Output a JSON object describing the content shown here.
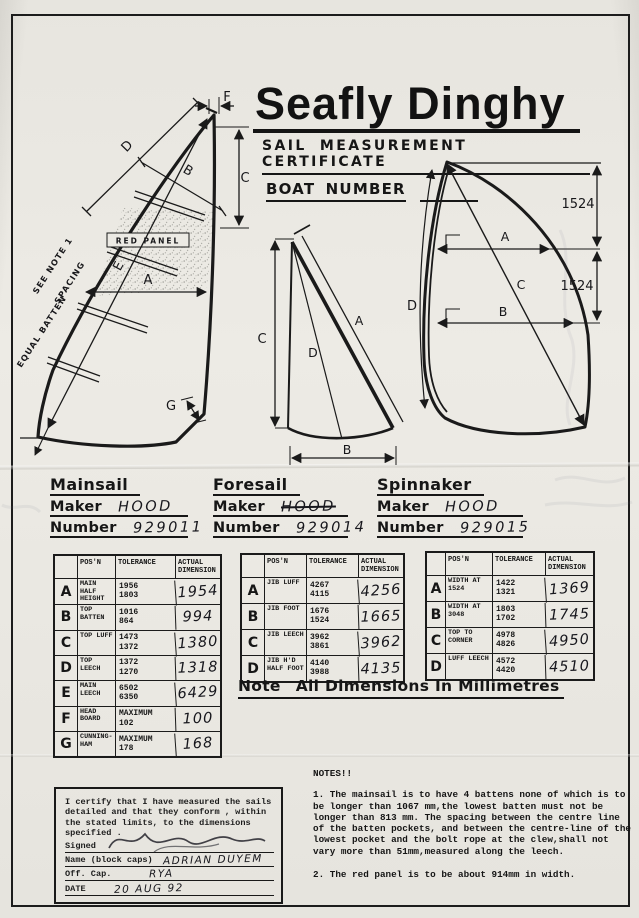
{
  "header": {
    "title": "Seafly Dinghy",
    "subtitle": "SAIL MEASUREMENT CERTIFICATE",
    "boat_number_label": "BOAT NUMBER"
  },
  "diagrams": {
    "mainsail": {
      "dim_f": "F",
      "dim_d": "D",
      "dim_b": "B",
      "dim_c": "C",
      "dim_e": "E",
      "dim_a": "A",
      "dim_g": "G",
      "red_panel_label": "RED PANEL",
      "see_note_label": "SEE NOTE 1",
      "spacing_label": "SPACING",
      "equal_batten_label": "EQUAL BATTEN"
    },
    "foresail": {
      "dim_c": "C",
      "dim_a": "A",
      "dim_d": "D",
      "dim_b": "B"
    },
    "spinnaker": {
      "dim_a": "A",
      "dim_b": "B",
      "dim_c": "C",
      "dim_d": "D",
      "upper_span_mm": "1524",
      "lower_span_mm": "1524"
    }
  },
  "sail_ids": {
    "maker_label": "Maker",
    "number_label": "Number",
    "mainsail": {
      "section_label": "Mainsail",
      "maker": "HOOD",
      "number": "929011"
    },
    "foresail": {
      "section_label": "Foresail",
      "maker": "HOOD",
      "number": "929014"
    },
    "spinnaker": {
      "section_label": "Spinnaker",
      "maker": "HOOD",
      "number": "929015"
    }
  },
  "tables": {
    "col_posn": "POS'N",
    "col_tolerance": "TOLERANCE",
    "col_actual": "ACTUAL DIMENSION",
    "mainsail": {
      "rows": [
        {
          "key": "A",
          "posn": "MAIN HALF HEIGHT",
          "tol_max": "1956",
          "tol_min": "1803",
          "actual": "1954"
        },
        {
          "key": "B",
          "posn": "TOP BATTEN",
          "tol_max": "1016",
          "tol_min": "864",
          "actual": "994"
        },
        {
          "key": "C",
          "posn": "TOP LUFF",
          "tol_max": "1473",
          "tol_min": "1372",
          "actual": "1380"
        },
        {
          "key": "D",
          "posn": "TOP LEECH",
          "tol_max": "1372",
          "tol_min": "1270",
          "actual": "1318"
        },
        {
          "key": "E",
          "posn": "MAIN LEECH",
          "tol_max": "6502",
          "tol_min": "6350",
          "actual": "6429"
        },
        {
          "key": "F",
          "posn": "HEAD BOARD",
          "tol_max": "MAXIMUM",
          "tol_min": "102",
          "actual": "100"
        },
        {
          "key": "G",
          "posn": "CUNNING-HAM",
          "tol_max": "MAXIMUM",
          "tol_min": "178",
          "actual": "168"
        }
      ]
    },
    "foresail": {
      "rows": [
        {
          "key": "A",
          "posn": "JIB LUFF",
          "tol_max": "4267",
          "tol_min": "4115",
          "actual": "4256"
        },
        {
          "key": "B",
          "posn": "JIB FOOT",
          "tol_max": "1676",
          "tol_min": "1524",
          "actual": "1665"
        },
        {
          "key": "C",
          "posn": "JIB LEECH",
          "tol_max": "3962",
          "tol_min": "3861",
          "actual": "3962"
        },
        {
          "key": "D",
          "posn": "JIB H'D HALF FOOT",
          "tol_max": "4140",
          "tol_min": "3988",
          "actual": "4135"
        }
      ]
    },
    "spinnaker": {
      "rows": [
        {
          "key": "A",
          "posn": "WIDTH AT 1524",
          "tol_max": "1422",
          "tol_min": "1321",
          "actual": "1369"
        },
        {
          "key": "B",
          "posn": "WIDTH AT 3048",
          "tol_max": "1803",
          "tol_min": "1702",
          "actual": "1745"
        },
        {
          "key": "C",
          "posn": "TOP TO CORNER",
          "tol_max": "4978",
          "tol_min": "4826",
          "actual": "4950"
        },
        {
          "key": "D",
          "posn": "LUFF LEECH",
          "tol_max": "4572",
          "tol_min": "4420",
          "actual": "4510"
        }
      ]
    }
  },
  "units_note": {
    "prefix": "Note",
    "text": "All Dimensions In Millimetres"
  },
  "certificate": {
    "body": "I certify that I have measured the sails detailed and that they conform , within the stated limits, to the dimensions specified .",
    "signed_label": "Signed",
    "name_label": "Name (block caps)",
    "name_value": "ADRIAN DUYEM",
    "off_cap_label": "Off. Cap.",
    "off_cap_value": "RYA",
    "date_label": "DATE",
    "date_value": "20 AUG 92"
  },
  "notes": {
    "heading": "NOTES!!",
    "note1": "1. The mainsail is to have 4 battens none of which is to be longer than 1067 mm,the lowest batten must not be longer than 813 mm. The spacing between the centre line of the batten pockets, and between the centre-line of the lowest pocket and the bolt rope at the clew,shall not vary more than 51mm,measured along the leech.",
    "note2": "2. The red panel is to be about 914mm in width."
  }
}
